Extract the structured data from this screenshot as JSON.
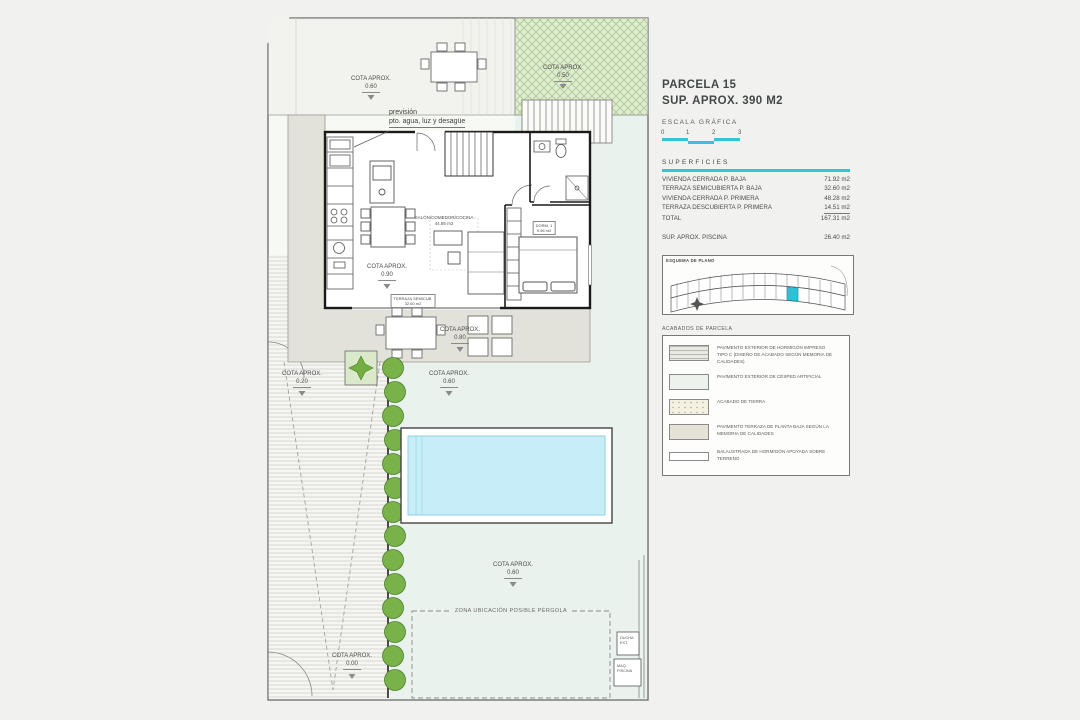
{
  "panel": {
    "title_line1": "PARCELA 15",
    "title_line2": "SUP. APROX. 390 M2",
    "escala": "ESCALA GRÁFICA",
    "scale_ticks": [
      "0",
      "1",
      "2",
      "3"
    ],
    "accent_color": "#35c4d7",
    "superficies": {
      "header": "SUPERFICIES",
      "rows": [
        {
          "label": "VIVIENDA CERRADA P. BAJA",
          "value": "71.92 m2"
        },
        {
          "label": "TERRAZA SEMICUBIERTA P. BAJA",
          "value": "32.60 m2"
        },
        {
          "label": "VIVIENDA CERRADA P. PRIMERA",
          "value": "48.28 m2"
        },
        {
          "label": "TERRAZA DESCUBIERTA P. PRIMERA",
          "value": "14.51 m2"
        },
        {
          "label": "TOTAL",
          "value": "167.31 m2"
        }
      ],
      "piscina": {
        "label": "SUP. APROX. PISCINA",
        "value": "26.40 m2"
      }
    },
    "keyplan": {
      "title": "ESQUEMA DE PLANO"
    },
    "legend": {
      "title": "ACABADOS DE PARCELA",
      "items": [
        "PAVIMENTO EXTERIOR DE HORMIGÓN IMPRESO TIPO C (DISEÑO DE ACABADO SEGÚN MEMORIA DE CALIDADES)",
        "PAVIMENTO EXTERIOR DE CÉSPED ARTIFICIAL",
        "ACABADO DE TIERRA",
        "PAVIMENTO TERRAZA DE PLANTA BAJA SEGÚN LA MEMORIA DE CALIDADES",
        "BALAUSTRADA DE HORMIGÓN APOYADA SOBRE TERRENO"
      ]
    }
  },
  "plan": {
    "labels": {
      "cota_caption": "COTA APROX.",
      "cota_tl": "0.60",
      "cota_grass": "0.50",
      "cota_090": "0.90",
      "cota_080": "0.80",
      "cota_020": "0.20",
      "cota_060_mid": "0.60",
      "cota_060_lawn": "0.60",
      "cota_000": "0.00",
      "prevision_1": "previsión",
      "prevision_2": "pto. agua, luz y desagüe",
      "salon_1": "SALÓN/COMEDOR/COCINA",
      "salon_2": "44.85 m2",
      "dorm_1": "DORM. 1",
      "dorm_2": "9.96 m2",
      "terraza_1": "TERRAZA SEMICUB.",
      "terraza_2": "32.60 m2",
      "pergola": "ZONA UBICACIÓN POSIBLE PÉRGOLA",
      "ducha_1": "DUCHA",
      "ducha_2": "EXT.",
      "maq_1": "MAQ.",
      "maq_2": "PISCINA"
    }
  }
}
